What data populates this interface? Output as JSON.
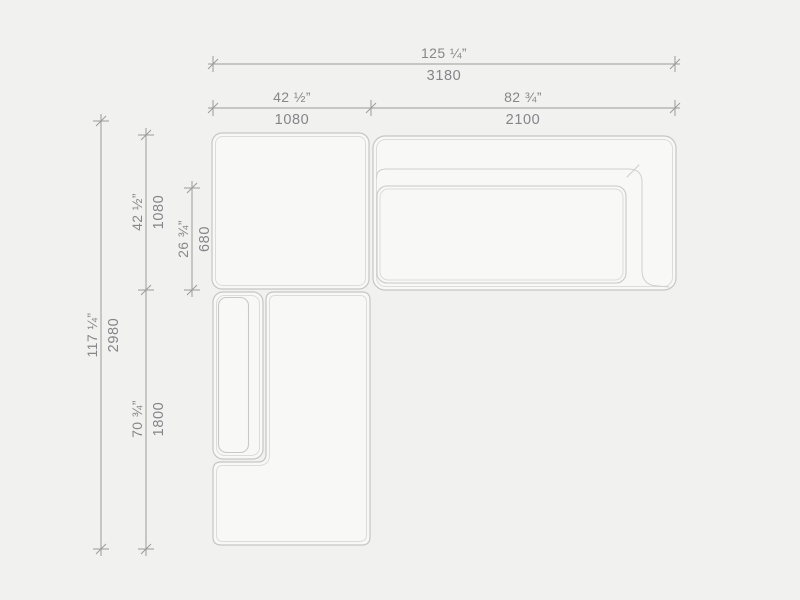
{
  "meta": {
    "title": "Sectional sofa — top view dimension drawing",
    "view": "plan"
  },
  "style": {
    "background_color": "#f1f1ef",
    "module_fill_color": "#f8f8f6",
    "outline_color": "#c6c6c4",
    "inner_outline_color": "#dcdcda",
    "dimension_line_color": "#9b9b99",
    "dimension_text_color": "#87878a"
  },
  "dimensions": {
    "overall_width": {
      "inches": "125 ¼”",
      "mm": "3180"
    },
    "left_module_width": {
      "inches": "42 ½”",
      "mm": "1080"
    },
    "right_module_width": {
      "inches": "82 ¾”",
      "mm": "2100"
    },
    "overall_depth": {
      "inches": "117 ¼”",
      "mm": "2980"
    },
    "upper_module_depth": {
      "inches": "42 ½”",
      "mm": "1080"
    },
    "seat_depth": {
      "inches": "26 ¾”",
      "mm": "680"
    },
    "lower_module_depth": {
      "inches": "70 ¾”",
      "mm": "1800"
    }
  }
}
